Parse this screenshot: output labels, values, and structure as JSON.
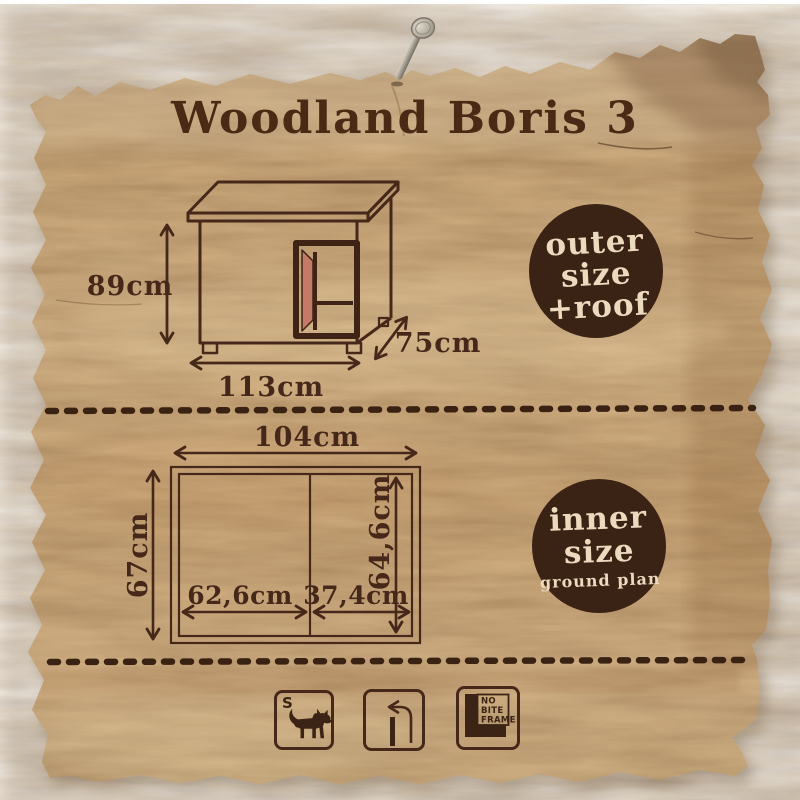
{
  "poster": {
    "title": "Woodland Boris 3",
    "outer_section": {
      "badge": {
        "line1": "outer",
        "line2": "size",
        "line3": "+roof"
      },
      "dimensions": {
        "height": "89cm",
        "width": "113cm",
        "depth": "75cm"
      }
    },
    "inner_section": {
      "badge": {
        "line1": "inner",
        "line2": "size",
        "line3": "ground plan"
      },
      "dimensions": {
        "total_width": "104cm",
        "total_depth": "67cm",
        "inner_depth": "64,6cm",
        "left_width": "62,6cm",
        "right_width": "37,4cm"
      }
    },
    "footer_icons": {
      "dog_size_label": "S",
      "no_bite_frame": {
        "line1": "NO",
        "line2": "BITE",
        "line3": "FRAME"
      }
    },
    "colors": {
      "line_brown": "#46281a",
      "badge_brown": "#3a2214",
      "badge_text_cream": "#ecdabf",
      "wood_base": "#cba97c",
      "door_accent": "#c47a66",
      "nail_gray": "#a8a296",
      "background": "#ffffff"
    }
  }
}
